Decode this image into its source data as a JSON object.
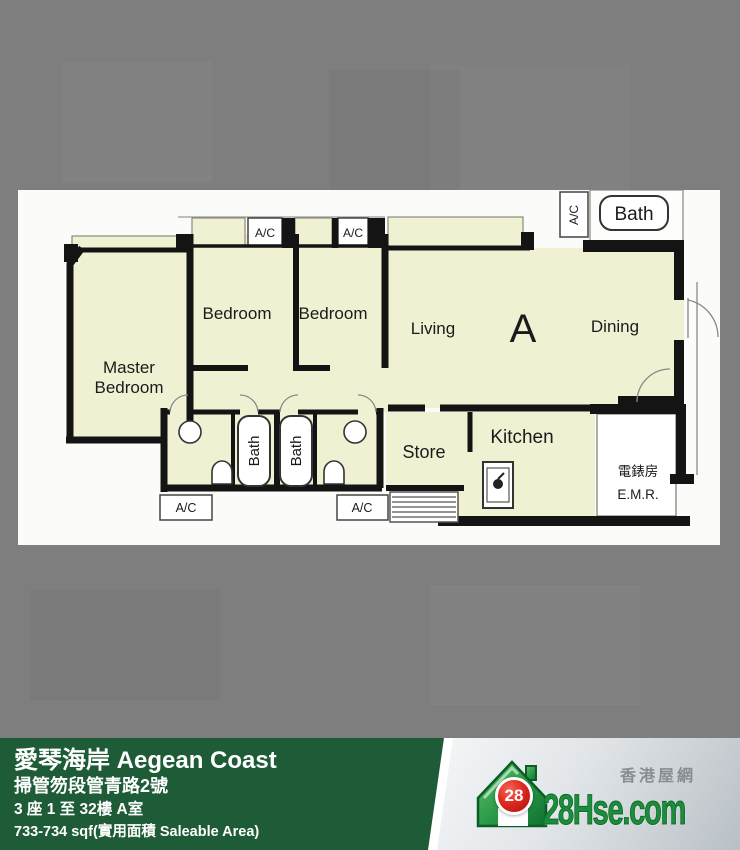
{
  "plan": {
    "labels": {
      "master_line1": "Master",
      "master_line2": "Bedroom",
      "bedroom": "Bedroom",
      "living": "Living",
      "unit": "A",
      "dining": "Dining",
      "store": "Store",
      "kitchen": "Kitchen",
      "bath": "Bath",
      "ac": "A/C",
      "emr_cn": "電錶房",
      "emr_en": "E.M.R."
    }
  },
  "footer": {
    "title": "愛琴海岸 Aegean Coast",
    "address": "掃管笏段管青路2號",
    "block_floor": "3 座 1 至 32樓 A室",
    "area": "733-734 sqf(實用面積 Saleable Area)"
  },
  "logo": {
    "badge": "28",
    "brand": "28Hse.com",
    "tagline": "香港屋網"
  },
  "colors": {
    "background": "#7e7e7e",
    "panel": "#fbfbf9",
    "room": "#f0f1d2",
    "wall": "#141414",
    "footer_green": "#1e5c38",
    "brand_green": "#1d8c3c",
    "badge_red": "#cf1d1d"
  }
}
